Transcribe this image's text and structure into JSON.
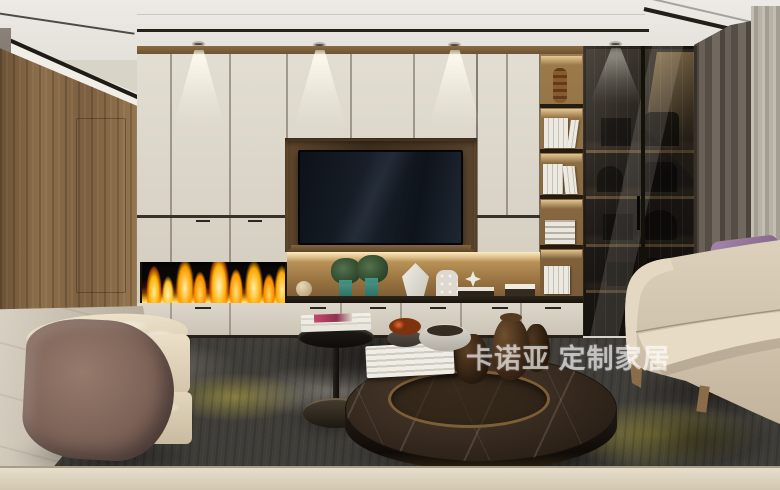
{
  "scene": {
    "type": "interior-3d-render",
    "room": "living-room",
    "description": "Modern living room render with cream custom TV wall cabinetry, recessed TV, linear fireplace, lit display niche, open bookshelf, smoked-glass display cabinet, gray curtains, cream sofa with purple pillow, curved suede armchair, round marble coffee table, black side table and dark mottled rug.",
    "objects": [
      "ceiling-downlights",
      "walnut-wood-wall",
      "cream-tv-wall-cabinets",
      "recessed-tv",
      "linear-fireplace",
      "lit-display-niche",
      "green-plants",
      "white-vases",
      "open-wood-bookshelf",
      "smoked-glass-display-cabinet",
      "gray-curtain",
      "sheer-curtain",
      "cream-sofa",
      "purple-pillow",
      "taupe-pillow",
      "curved-suede-armchair",
      "round-marble-coffee-table",
      "black-side-table",
      "magazines",
      "bronze-tray",
      "amber-glass-jars",
      "orange-bloom-bowl",
      "white-stone-bowl",
      "book-stacks",
      "dark-mottled-rug",
      "light-marble-floor",
      "foreground-table-edge"
    ]
  },
  "watermark": {
    "text": "卡诺亚 定制家居",
    "brand": "卡诺亚",
    "tagline": "定制家居"
  },
  "palette": {
    "cabinet_cream": "#dcd6ca",
    "wood": "#8a6c49",
    "tv_black": "#131921",
    "flame_orange": "#ffa81f",
    "glass_dark": "#211c17",
    "curtain_gray": "#5d564e",
    "sofa_cream": "#d7cab5",
    "pillow_purple": "#8f6b94",
    "chair_mauve": "#84675c",
    "rug_charcoal": "#403e39",
    "rug_yellow": "#c8b839",
    "floor_beige": "#cfc7b8",
    "marble_brown": "#33271d"
  }
}
